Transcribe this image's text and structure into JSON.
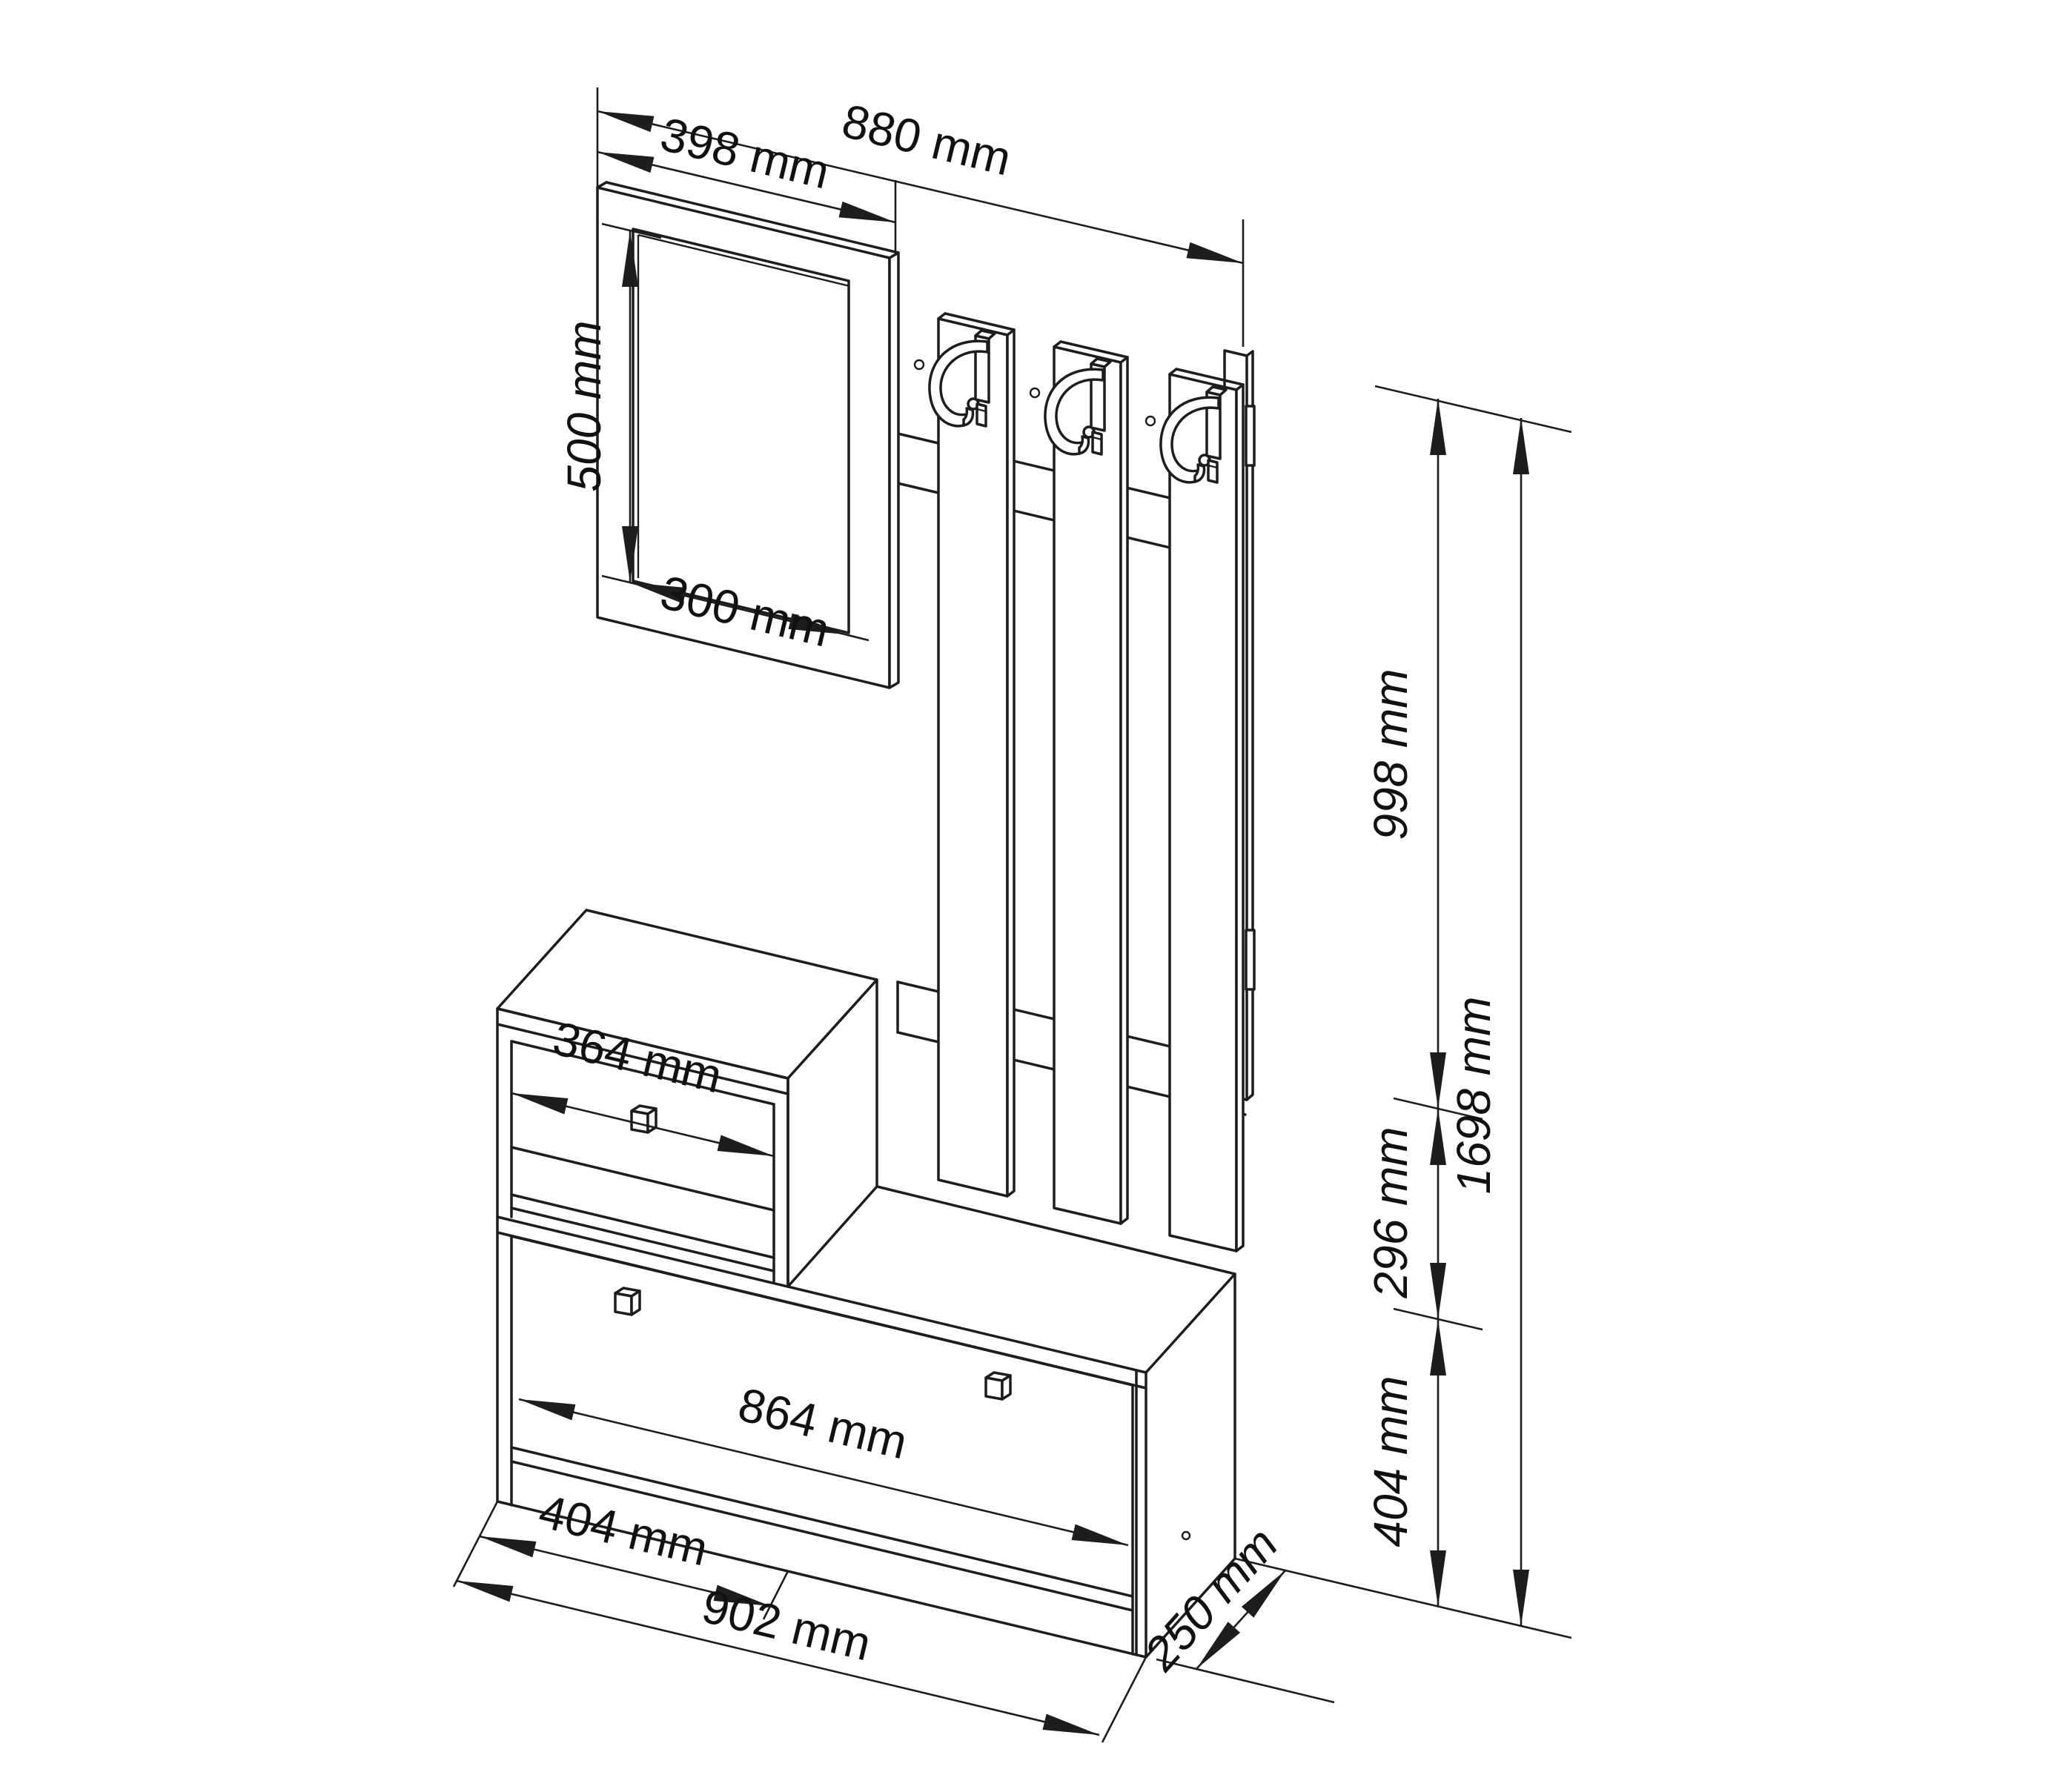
{
  "drawing": {
    "kind": "isometric technical line drawing",
    "product": "hallway furniture set: wall mirror, coat-rack panel with three hooks, shoe bench with drawer",
    "background_color": "#ffffff",
    "line_color": "#1d1d1d",
    "units": "mm"
  },
  "labels": {
    "mirror_frame_width": "398 mm",
    "total_width": "880 mm",
    "mirror_glass_height": "500 mm",
    "mirror_glass_width": "300 mm",
    "drawer_front_width": "364 mm",
    "flap_front_width": "864 mm",
    "drawer_cabinet_width": "404 mm",
    "bench_width": "902 mm",
    "bench_depth": "250 mm",
    "wall_panel_height": "998 mm",
    "drawer_cabinet_height": "296 mm",
    "bench_height": "404 mm",
    "total_height": "1698 mm"
  }
}
